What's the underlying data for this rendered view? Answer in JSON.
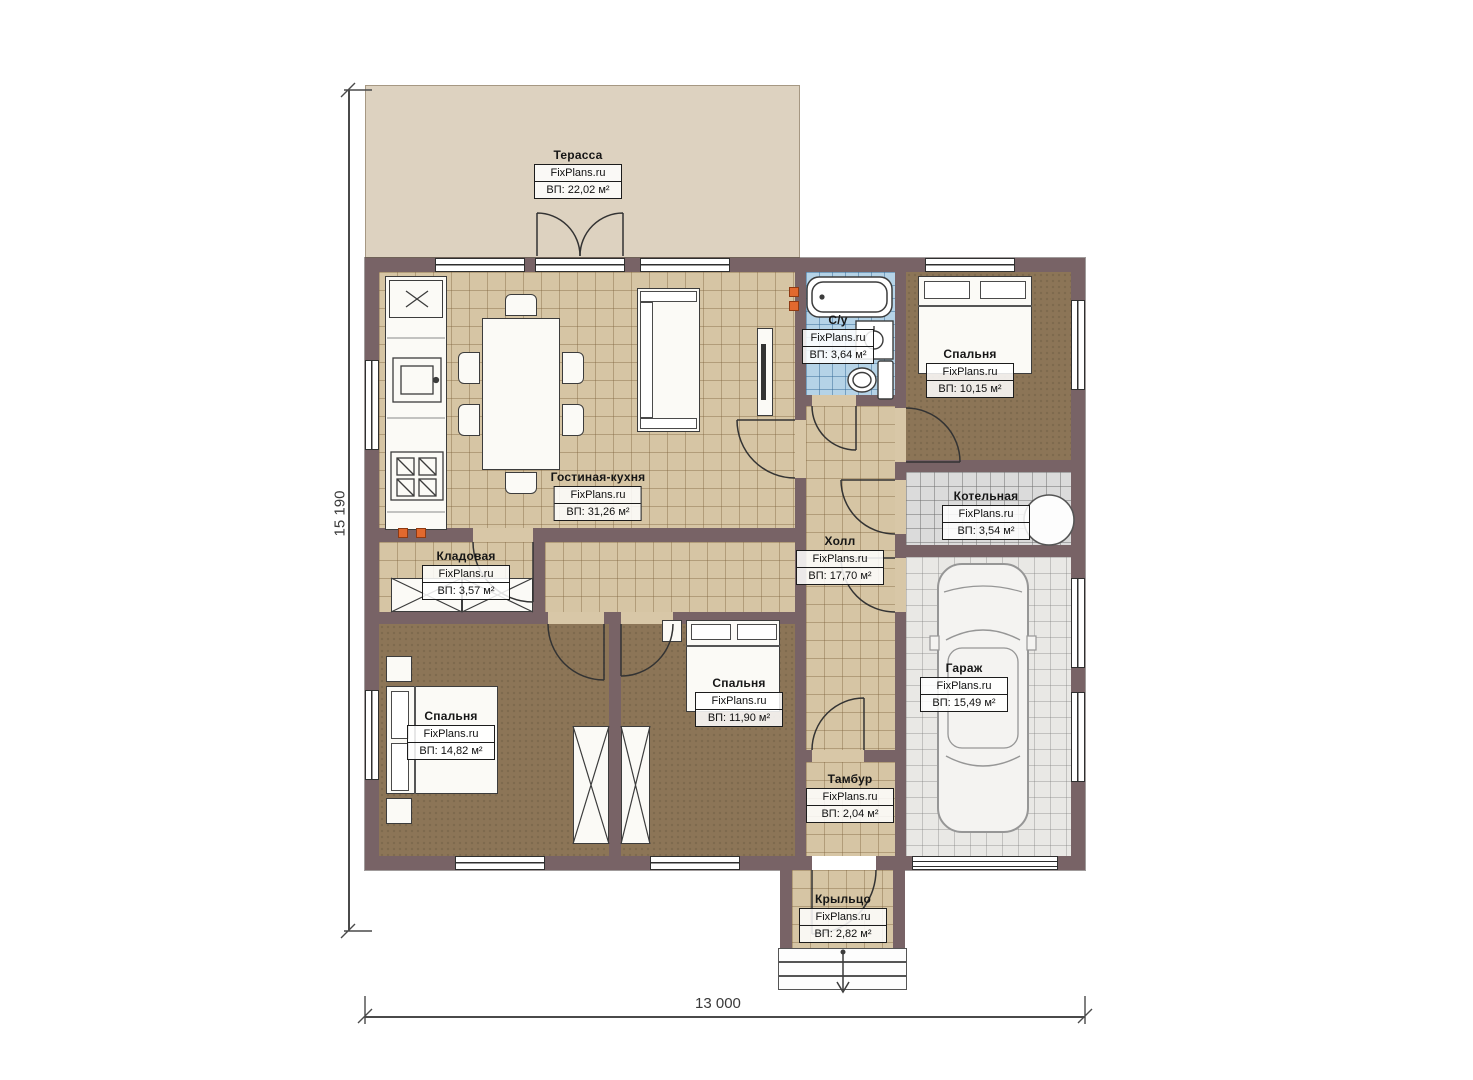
{
  "plan": {
    "brand": "FixPlans.ru",
    "dimensions": {
      "width": "13 000",
      "height": "15 190"
    },
    "rooms": [
      {
        "key": "terrace",
        "name": "Терасса",
        "area": "ВП: 22,02 м²"
      },
      {
        "key": "living-kitchen",
        "name": "Гостиная-кухня",
        "area": "ВП: 31,26 м²"
      },
      {
        "key": "bathroom",
        "name": "С/у",
        "area": "ВП: 3,64 м²"
      },
      {
        "key": "bedroom-top-right",
        "name": "Спальня",
        "area": "ВП: 10,15 м²"
      },
      {
        "key": "boiler-room",
        "name": "Котельная",
        "area": "ВП: 3,54 м²"
      },
      {
        "key": "hall",
        "name": "Холл",
        "area": "ВП: 17,70 м²"
      },
      {
        "key": "storage",
        "name": "Кладовая",
        "area": "ВП: 3,57 м²"
      },
      {
        "key": "bedroom-bottom-left",
        "name": "Спальня",
        "area": "ВП: 14,82 м²"
      },
      {
        "key": "bedroom-middle",
        "name": "Спальня",
        "area": "ВП: 11,90 м²"
      },
      {
        "key": "garage",
        "name": "Гараж",
        "area": "ВП: 15,49 м²"
      },
      {
        "key": "vestibule",
        "name": "Тамбур",
        "area": "ВП: 2,04 м²"
      },
      {
        "key": "porch",
        "name": "Крыльцо",
        "area": "ВП: 2,82 м²"
      }
    ],
    "colors": {
      "wall": "#786366",
      "floor_tile": "#d6c5a4",
      "carpet": "#8c7557",
      "bath_tile": "#b5d3e7",
      "utility_tile": "#dbdbdb",
      "terrace": "#ddd2c0",
      "vent": "#e2692e"
    }
  }
}
